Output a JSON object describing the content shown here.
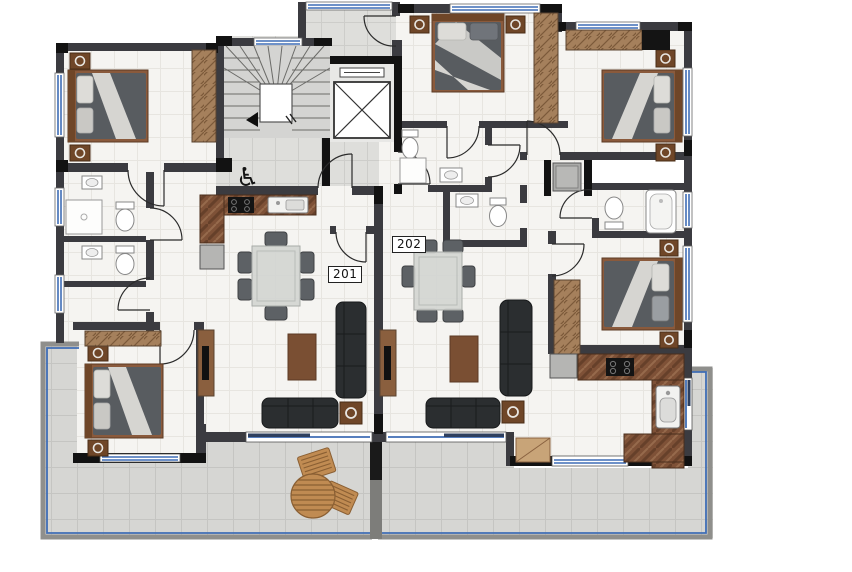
{
  "page": {
    "type": "architectural-floor-plan",
    "floor": "apartment level with units 201 and 202"
  },
  "units": [
    {
      "label": "201",
      "rooms": [
        "bedroom",
        "bedroom",
        "bathroom",
        "bathroom",
        "kitchen",
        "living-dining",
        "balcony"
      ]
    },
    {
      "label": "202",
      "rooms": [
        "bedroom",
        "bedroom",
        "bedroom",
        "bathroom",
        "bathroom",
        "bathroom",
        "kitchen",
        "living-dining",
        "balcony",
        "entry-terrace"
      ]
    }
  ],
  "core": {
    "features": [
      "staircase",
      "elevator",
      "accessible-entrance"
    ],
    "wheelchair_icon": "♿"
  },
  "colors": {
    "wall_gray": "#3b3b40",
    "wall_black": "#121212",
    "interior_floor": "#f5f4f1",
    "lobby_floor": "#dededb",
    "balcony_floor": "#d6d6d3",
    "window_blue": "#3f6db5",
    "wood": "#a5805c",
    "wood_dark": "#6f4628",
    "marble_counter": "#7e5137",
    "sofa_dark": "#2b2e30",
    "bed_blanket": "#5a5e62",
    "glass_table": "#d2d5d1"
  }
}
